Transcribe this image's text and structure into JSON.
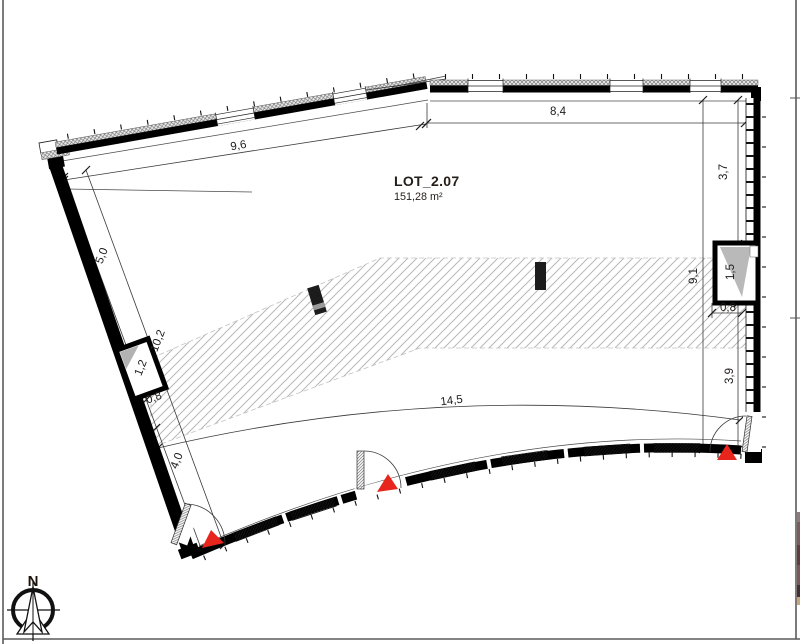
{
  "lot": {
    "title": "LOT_2.07",
    "area": "151,28 m²"
  },
  "compass": {
    "north": "N"
  },
  "dims": {
    "top_left": "9,6",
    "top": "8,4",
    "right_upper": "3,7",
    "right_total": "9,1",
    "right_shaft": "1,5",
    "right_shaft_depth": "0,8",
    "right_lower": "3,9",
    "left_upper": "5,0",
    "left_total": "10,2",
    "left_shaft": "1,2",
    "left_shaft_offset": "0,8",
    "left_lower": "4,0",
    "bottom": "14,5"
  },
  "colors": {
    "entrance_marker": "#e8251d",
    "wall": "#000000",
    "hatch_line": "#b8b8b8",
    "shading": "#b2b2b2"
  },
  "sliver": {
    "c0": "#8e797c",
    "c1": "#7d5a60",
    "c2": "#5f3a40",
    "c3": "#7a555a",
    "c4": "#462f33",
    "c5": "#c9a77c"
  }
}
